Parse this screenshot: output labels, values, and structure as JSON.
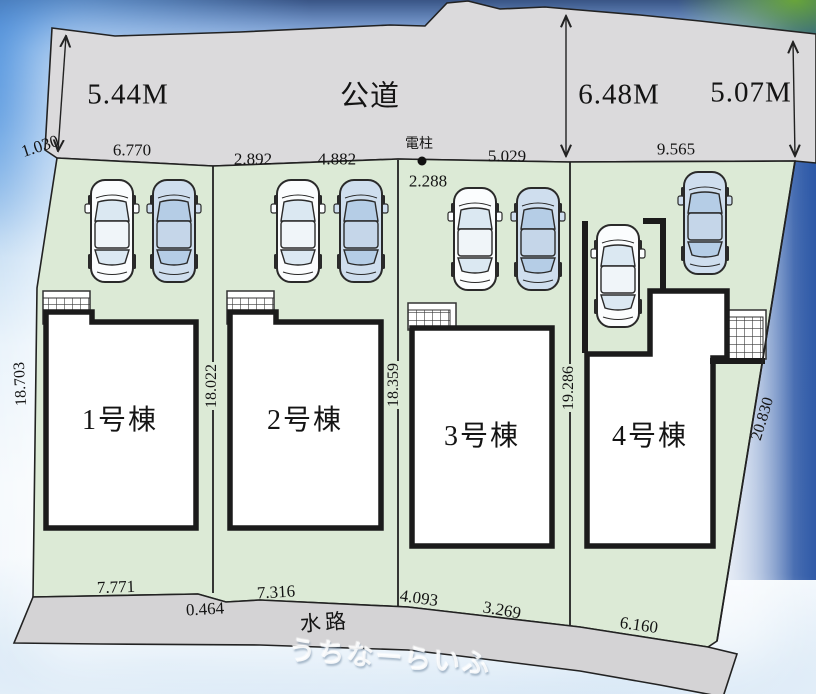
{
  "road": {
    "name": "公道",
    "width_left": "5.44M",
    "width_center": "6.48M",
    "width_right": "5.07M",
    "frontage_dims": {
      "d1": "1.030",
      "d2": "6.770",
      "d3": "2.892",
      "d4": "4.882",
      "d5": "5.029",
      "d6": "9.565"
    }
  },
  "utility_pole": {
    "label": "電柱",
    "distance": "2.288"
  },
  "side_dims": {
    "left": "18.703",
    "lot12": "18.022",
    "lot23": "18.359",
    "lot34": "19.286",
    "right": "20.830"
  },
  "bottom_dims": {
    "lot1": "7.771",
    "step": "0.464",
    "lot2": "7.316",
    "lot3_left": "4.093",
    "lot3_right": "3.269",
    "lot4": "6.160"
  },
  "waterway": {
    "name": "水路"
  },
  "buildings": [
    {
      "name": "1号棟"
    },
    {
      "name": "2号棟"
    },
    {
      "name": "3号棟"
    },
    {
      "name": "4号棟"
    }
  ],
  "watermark": {
    "text": "うちなーらいふ"
  },
  "colors": {
    "lot_green": "#dcead6",
    "road_gray": "#dbdadc",
    "building_white": "#ffffff",
    "outline": "#1c1c1c",
    "sky_blue": "#4c8ad6"
  }
}
